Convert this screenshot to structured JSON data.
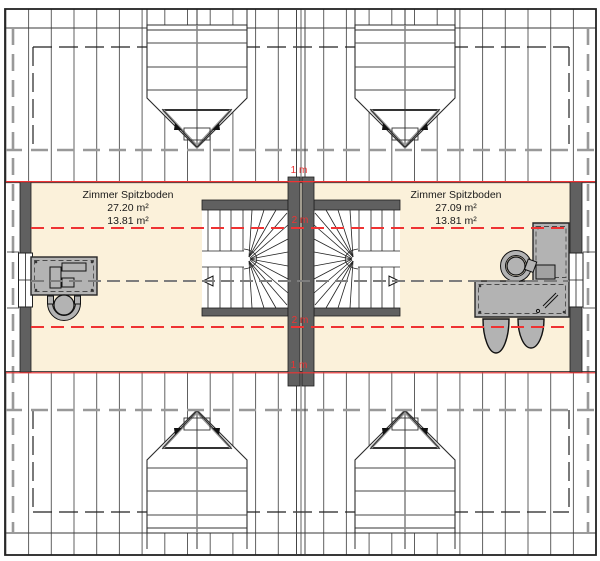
{
  "plan": {
    "rooms": [
      {
        "name": "Zimmer Spitzboden",
        "area_total": "27.20 m²",
        "area_reduced": "13.81 m²"
      },
      {
        "name": "Zimmer Spitzboden",
        "area_total": "27.09 m²",
        "area_reduced": "13.81 m²"
      }
    ],
    "height_markers": {
      "top_1m": "1 m",
      "upper_2m": "2 m",
      "lower_2m": "2 m",
      "bottom_1m": "1 m"
    },
    "colors": {
      "room_fill": "#FBF1DA",
      "wall_gray": "#606060",
      "red": "#EE3333",
      "furn": "#B3B3B3"
    }
  }
}
